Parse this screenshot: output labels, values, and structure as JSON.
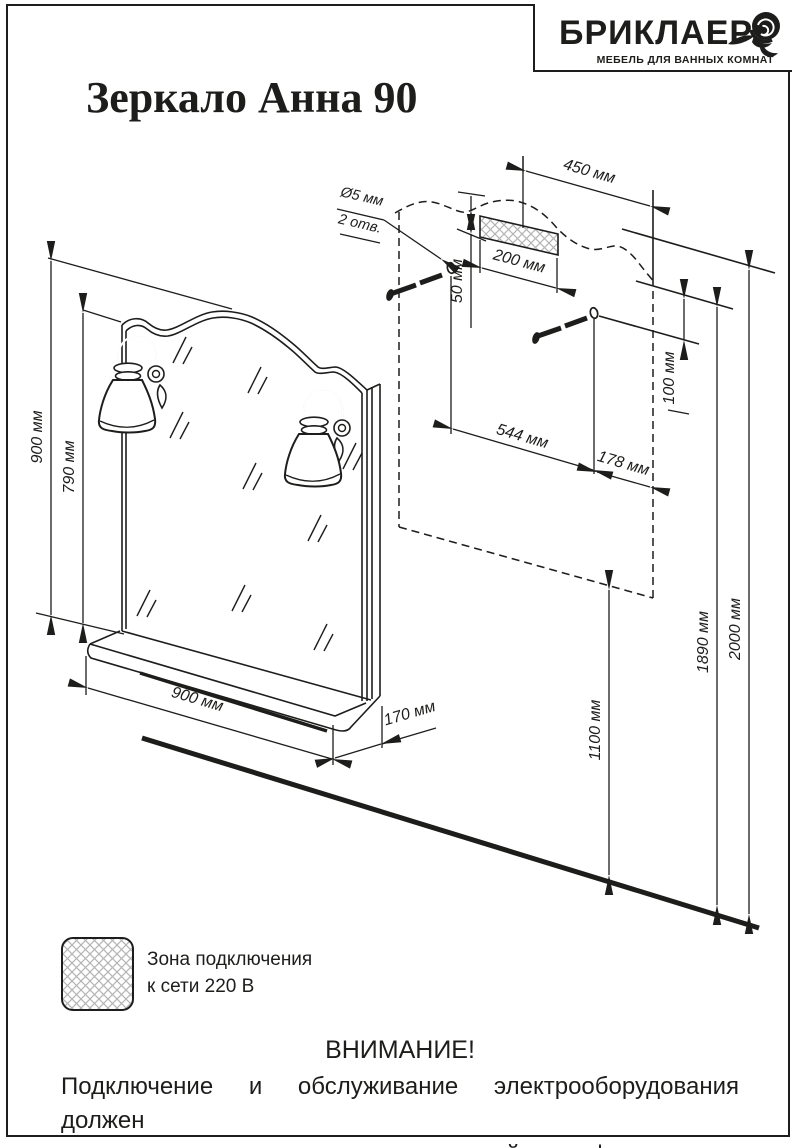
{
  "header": {
    "logo": {
      "brand": "БРИКЛАЕР",
      "subtitle": "МЕБЕЛЬ ДЛЯ ВАННЫХ КОМНАТ"
    },
    "title": "Зеркало Анна 90"
  },
  "diagram": {
    "dims": {
      "d450": "450 мм",
      "d200": "200 мм",
      "d50": "50 мм",
      "hole_dia": "Ø5 мм",
      "hole_count": "2 отв.",
      "d544": "544 мм",
      "d178": "178 мм",
      "d100": "100 мм",
      "height_total": "900 мм",
      "height_mirror": "790 мм",
      "width_shelf": "900 мм",
      "depth_shelf": "170 мм",
      "h1100": "1100 мм",
      "h1890": "1890 мм",
      "h2000": "2000 мм"
    }
  },
  "legend": {
    "line1": "Зона подключения",
    "line2": "к сети 220 В"
  },
  "warning": {
    "heading": "ВНИМАНИЕ!",
    "line1": "Подключение и обслуживание электрооборудования должен",
    "line2": "выполнять специалист соответствующей квалификации."
  }
}
